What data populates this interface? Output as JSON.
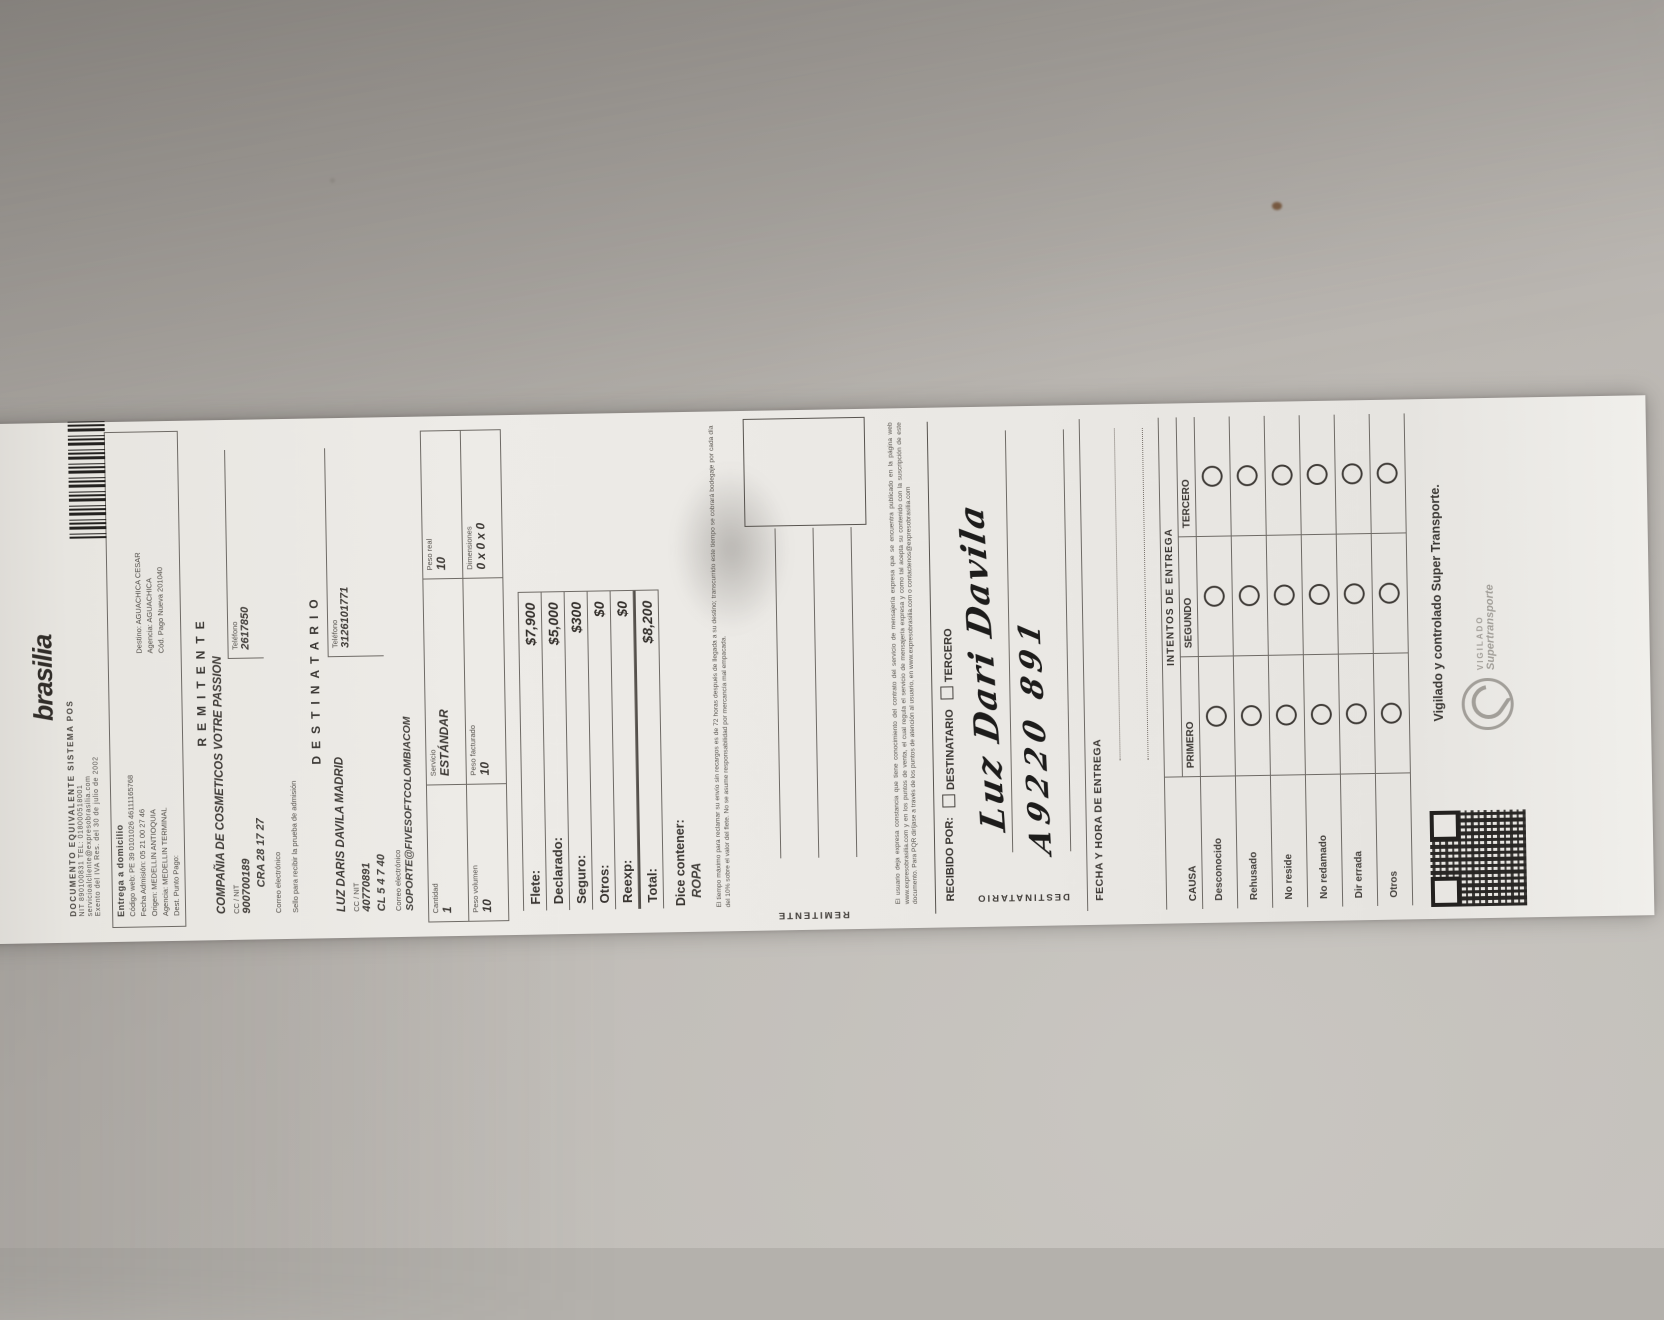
{
  "receipt": {
    "header": {
      "logo": "brasilia",
      "doc": "DOCUMENTO EQUIVALENTE SISTEMA POS",
      "line1": "NIT 890100831   TEL: 018000518001",
      "line2": "servicioalcliente@expresobrasilia.com",
      "line3": "Exento del IVA Res. del 30 de julio de 2002"
    },
    "admission": {
      "title": "Entrega a domicilio",
      "codigo": "Código web:  PE 39 0101026 46111165768",
      "rows": [
        {
          "left": "Fecha Admisión: 05 21 00 27 46",
          "right": "Destino: AGUACHICA CESAR"
        },
        {
          "left": "Origen: MEDELLIN ANTIOQUIA",
          "right": "Agencia: AGUACHICA"
        },
        {
          "left": "Agencia: MEDELLIN TERMINAL",
          "right": "Cód. Pago Nueva 201040"
        },
        {
          "left": "Dest. Punto Pago:",
          "right": ""
        }
      ]
    },
    "sender": {
      "section": "REMITENTE",
      "name": "COMPAÑIA DE COSMETICOS VOTRE PASSION",
      "id_label": "CC / NIT",
      "id": "900700189",
      "phone_label": "Teléfono",
      "phone": "2617850",
      "address": "CRA 28 17 27",
      "email_label": "Correo electrónico",
      "sello": "Sello para recibir la prueba de admisión"
    },
    "recipient": {
      "section": "DESTINATARIO",
      "name": "LUZ DARIS DAVILA MADRID",
      "id_label": "CC / NIT",
      "id": "40770891",
      "phone_label": "Teléfono",
      "phone": "3126101771",
      "address": "CL 5 4 7 40",
      "email_label": "Correo electrónico",
      "email": "SOPORTE@FIVESOFTCOLOMBIACOM"
    },
    "service": [
      {
        "label": "Cantidad",
        "value": "1"
      },
      {
        "label": "Servicio",
        "value": "ESTÁNDAR"
      },
      {
        "label": "Peso real",
        "value": "10"
      },
      {
        "label": "Peso volumen",
        "value": "10"
      },
      {
        "label": "Peso facturado",
        "value": "10"
      },
      {
        "label": "Dimensiones",
        "value": "0 x 0 x 0"
      }
    ],
    "charges": [
      {
        "label": "Flete:",
        "value": "$7,900"
      },
      {
        "label": "Declarado:",
        "value": "$5,000"
      },
      {
        "label": "Seguro:",
        "value": "$300"
      },
      {
        "label": "Otros:",
        "value": "$0"
      },
      {
        "label": "Reexp:",
        "value": "$0"
      },
      {
        "label": "Total:",
        "value": "$8,200"
      }
    ],
    "contents": {
      "label": "Dice contener:",
      "value": "ROPA"
    },
    "fineprint1": "El tiempo máximo para reclamar su envío sin recargos es de 72 horas después de llegada a su destino; transcurrido este tiempo se cobrará bodegaje por cada día del 10% sobre el valor del flete. No se asume responsabilidad por mercancía mal empacada.",
    "fineprint2": "El usuario deja expresa constancia que tiene conocimiento del contrato del servicio de mensajería expresa que se encuentra publicado en la página web www.expresobrasilia.com y en los puntos de venta, el cual regula el servicio de mensajería expresa y como tal acepta su contenido con la suscripción de este documento. Para PQR diríjase a través de los puntos de atención al usuario, en www.expresobrasilia.com o contactenos@expresobrasilia.com",
    "received": {
      "title": "RECIBIDO POR:",
      "option1": "DESTINATARIO",
      "option2": "TERCERO",
      "sender_row_label": "REMITENTE",
      "recipient_row_label": "DESTINATARIO",
      "handwriting_name": "Luz Dari Davila",
      "handwriting_id": "A9220 891"
    },
    "delivery": {
      "fecha_label": "FECHA Y HORA DE ENTREGA",
      "intents_title": "INTENTOS DE ENTREGA",
      "causa_label": "CAUSA",
      "attempts": [
        "PRIMERO",
        "SEGUNDO",
        "TERCERO"
      ],
      "causes": [
        "Desconocido",
        "Rehusado",
        "No reside",
        "No redamado",
        "Dir errada",
        "Otros"
      ]
    },
    "footer": {
      "vigilado": "Vigilado y controlado Super Transporte.",
      "brand_small": "VIGILADO",
      "brand": "Supertransporte"
    }
  }
}
